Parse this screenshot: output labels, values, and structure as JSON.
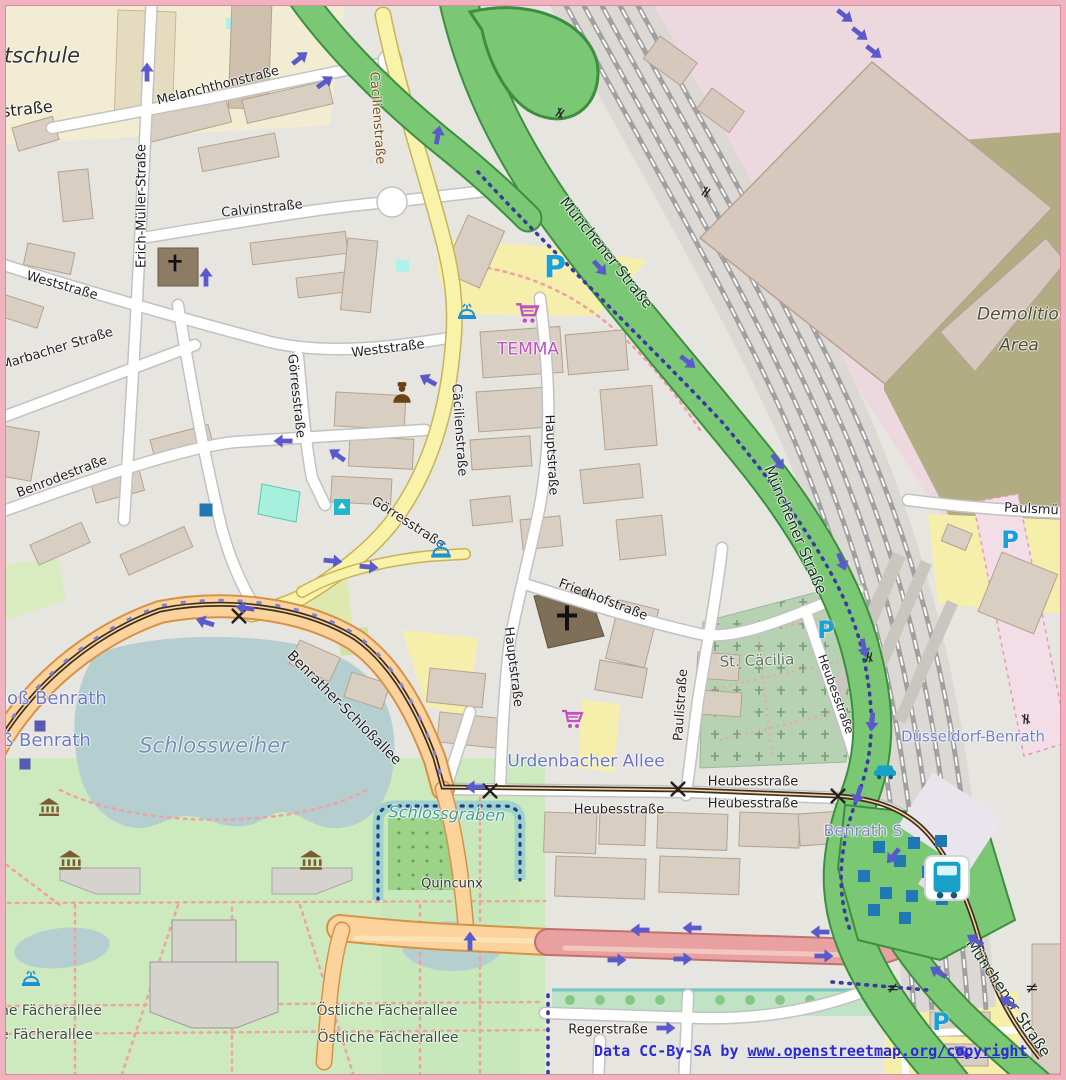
{
  "map": {
    "attribution": {
      "prefix": "Data CC-By-SA by ",
      "link": "www.openstreetmap.org/copyright"
    },
    "colors": {
      "frame_pink": "#f1b2c0",
      "residential_bg": "#e7e5e0",
      "building": "#d8cec2",
      "road_yellow": "#f8f3a8",
      "road_orange": "#fcd39c",
      "road_green_trunk": "#7ac873",
      "road_red": "#e9a0a0",
      "water": "#b5cfd1",
      "park_green": "#cdeabf",
      "cemetery_green": "#b7d2b2",
      "industrial_pink": "#edd8e0",
      "brownfield_khaki": "#b2ac83",
      "label_blue_place": "#6b79c8",
      "label_water_blue": "#7292b2",
      "temma_magenta": "#c050c0",
      "parking_blue": "#18a0d8",
      "oneway_arrow": "#5a5acd",
      "attribution_blue": "#2b2bd6"
    },
    "labels": [
      {
        "t": "tschule",
        "x": 4,
        "y": 56,
        "s": 21,
        "c": "#333333",
        "a": "l",
        "i": true
      },
      {
        "t": "straße",
        "x": 2,
        "y": 112,
        "s": 16,
        "c": "#222222",
        "a": "l",
        "r": -6
      },
      {
        "t": "Melanchthonstraße",
        "x": 218,
        "y": 86,
        "r": -14,
        "s": 13
      },
      {
        "t": "Erich-Müller-Straße",
        "x": 142,
        "y": 206,
        "r": -90,
        "s": 13
      },
      {
        "t": "Calvinstraße",
        "x": 262,
        "y": 209,
        "r": -6,
        "s": 13
      },
      {
        "t": "Weststraße",
        "x": 62,
        "y": 286,
        "r": 16,
        "s": 13
      },
      {
        "t": "Weststraße",
        "x": 388,
        "y": 349,
        "r": -7,
        "s": 13
      },
      {
        "t": "Marbacher Straße",
        "x": 57,
        "y": 349,
        "r": -17,
        "s": 13
      },
      {
        "t": "Benrodestraße",
        "x": 62,
        "y": 477,
        "r": -21,
        "s": 13
      },
      {
        "t": "Görresstraße",
        "x": 296,
        "y": 396,
        "r": 84,
        "s": 13
      },
      {
        "t": "Görresstraße",
        "x": 408,
        "y": 523,
        "r": 33,
        "s": 13
      },
      {
        "t": "Cäcilienstraße",
        "x": 377,
        "y": 118,
        "r": 86,
        "s": 13,
        "c": "#7a4e18"
      },
      {
        "t": "Cäcilienstraße",
        "x": 459,
        "y": 430,
        "r": 86,
        "s": 13
      },
      {
        "t": "Hauptstraße",
        "x": 551,
        "y": 455,
        "r": 87,
        "s": 13
      },
      {
        "t": "Hauptstraße",
        "x": 513,
        "y": 667,
        "r": 83,
        "s": 13
      },
      {
        "t": "Münchener Straße",
        "x": 606,
        "y": 253,
        "r": 51,
        "s": 15,
        "c": "#17301c"
      },
      {
        "t": "Münchener Straße",
        "x": 795,
        "y": 530,
        "r": 67,
        "s": 15,
        "c": "#17301c"
      },
      {
        "t": "Münchener Straße",
        "x": 1008,
        "y": 998,
        "r": 56,
        "s": 15,
        "c": "#17301c"
      },
      {
        "t": "Demolition",
        "x": 977,
        "y": 315,
        "s": 17,
        "c": "#4c4c38",
        "i": true,
        "a": "l"
      },
      {
        "t": "Area",
        "x": 1019,
        "y": 346,
        "s": 17,
        "c": "#4c4c38",
        "i": true
      },
      {
        "t": "TEMMA",
        "x": 528,
        "y": 350,
        "s": 17,
        "c": "#c050c0"
      },
      {
        "t": "Friedhofstraße",
        "x": 603,
        "y": 600,
        "r": 21,
        "s": 13
      },
      {
        "t": "St. Cäcilia",
        "x": 757,
        "y": 661,
        "r": -2,
        "s": 15,
        "c": "#5d6e5d"
      },
      {
        "t": "Paulistraße",
        "x": 681,
        "y": 705,
        "r": -86,
        "s": 13
      },
      {
        "t": "Heubesstraße",
        "x": 836,
        "y": 694,
        "r": 70,
        "s": 12
      },
      {
        "t": "Paulsmü",
        "x": 1004,
        "y": 508,
        "s": 13,
        "a": "l",
        "r": 3
      },
      {
        "t": "Düsseldorf-Benrath",
        "x": 973,
        "y": 737,
        "s": 15,
        "c": "#7080c8"
      },
      {
        "t": "loß Benrath",
        "x": 2,
        "y": 699,
        "s": 18,
        "c": "#6b79c8",
        "a": "l"
      },
      {
        "t": "ß Benrath",
        "x": 2,
        "y": 741,
        "s": 18,
        "c": "#6b79c8",
        "a": "l"
      },
      {
        "t": "Schlossweiher",
        "x": 214,
        "y": 746,
        "s": 21,
        "c": "#7292b2",
        "i": true
      },
      {
        "t": "Benrather-Schloßallee",
        "x": 344,
        "y": 708,
        "r": 45,
        "s": 14
      },
      {
        "t": "Schlossgraben",
        "x": 447,
        "y": 814,
        "s": 16,
        "c": "#3e9d9d",
        "i": true,
        "r": 2
      },
      {
        "t": "Urdenbacher Allee",
        "x": 586,
        "y": 762,
        "s": 17,
        "c": "#6b74c8"
      },
      {
        "t": "Heubesstraße",
        "x": 753,
        "y": 782,
        "s": 13
      },
      {
        "t": "Heubesstraße",
        "x": 619,
        "y": 810,
        "s": 13
      },
      {
        "t": "Heubesstraße",
        "x": 753,
        "y": 804,
        "s": 13
      },
      {
        "t": "Benrath S",
        "x": 863,
        "y": 831,
        "s": 16,
        "c": "#8a7fd0"
      },
      {
        "t": "Quincunx",
        "x": 452,
        "y": 884,
        "s": 13,
        "c": "#333333"
      },
      {
        "t": "he Fächerallee",
        "x": 0,
        "y": 1011,
        "s": 14,
        "c": "#3d4d3d",
        "a": "l"
      },
      {
        "t": "e Fächerallee",
        "x": 0,
        "y": 1035,
        "s": 14,
        "c": "#3d4d3d",
        "a": "l"
      },
      {
        "t": "Östliche Fächerallee",
        "x": 387,
        "y": 1011,
        "s": 14,
        "c": "#3d4d3d"
      },
      {
        "t": "Östliche Fächerallee",
        "x": 388,
        "y": 1038,
        "s": 14,
        "c": "#3d4d3d"
      },
      {
        "t": "Regerstraße",
        "x": 608,
        "y": 1030,
        "s": 13
      }
    ],
    "icons": [
      {
        "n": "parking-icon",
        "k": "parking",
        "x": 555,
        "y": 268,
        "s": 30,
        "c": "#18a0d8"
      },
      {
        "n": "parking-icon",
        "k": "parking",
        "x": 826,
        "y": 630,
        "s": 24,
        "c": "#18a0d8"
      },
      {
        "n": "parking-icon",
        "k": "parking",
        "x": 1010,
        "y": 540,
        "s": 24,
        "c": "#18a0d8"
      },
      {
        "n": "parking-icon",
        "k": "parking",
        "x": 941,
        "y": 1022,
        "s": 24,
        "c": "#18a0d8"
      },
      {
        "n": "supermarket-cart-icon",
        "k": "cart",
        "x": 527,
        "y": 313,
        "s": 26,
        "c": "#c050c0"
      },
      {
        "n": "supermarket-cart-icon",
        "k": "cart",
        "x": 572,
        "y": 719,
        "s": 24,
        "c": "#c050c0"
      },
      {
        "n": "church-cross-icon",
        "k": "church",
        "x": 175,
        "y": 263,
        "s": 20,
        "c": "#111111"
      },
      {
        "n": "church-cross-icon",
        "k": "church",
        "x": 567,
        "y": 618,
        "s": 30,
        "c": "#111111"
      },
      {
        "n": "fountain-icon",
        "k": "fountain",
        "x": 467,
        "y": 311,
        "s": 24,
        "c": "#2090d8"
      },
      {
        "n": "fountain-icon",
        "k": "fountain",
        "x": 441,
        "y": 549,
        "s": 26,
        "c": "#2090d8"
      },
      {
        "n": "fountain-icon",
        "k": "fountain",
        "x": 31,
        "y": 978,
        "s": 24,
        "c": "#2090d8"
      },
      {
        "n": "museum-icon",
        "k": "museum",
        "x": 49,
        "y": 807,
        "s": 24,
        "c": "#7a5c2e"
      },
      {
        "n": "museum-icon",
        "k": "museum",
        "x": 70,
        "y": 860,
        "s": 26,
        "c": "#7a5c2e"
      },
      {
        "n": "museum-icon",
        "k": "museum",
        "x": 311,
        "y": 860,
        "s": 26,
        "c": "#7a5c2e"
      },
      {
        "n": "post-office-icon",
        "k": "post",
        "x": 402,
        "y": 393,
        "s": 26,
        "c": "#6a4418"
      },
      {
        "n": "recycling-icon",
        "k": "recycle",
        "x": 342,
        "y": 507,
        "s": 16,
        "c": "#20b8c8"
      },
      {
        "n": "poi-blue-square-icon",
        "k": "sq",
        "x": 206,
        "y": 510,
        "s": 13,
        "c": "#1f77b4"
      },
      {
        "n": "tram-stop-icon",
        "k": "sq",
        "x": 40,
        "y": 726,
        "s": 11,
        "c": "#5a5ab0"
      },
      {
        "n": "tram-stop-icon",
        "k": "sq",
        "x": 25,
        "y": 764,
        "s": 11,
        "c": "#5a5ab0"
      },
      {
        "n": "bus-stop-icon",
        "k": "sq",
        "x": 879,
        "y": 847,
        "s": 12,
        "c": "#1f77b4"
      },
      {
        "n": "bus-stop-icon",
        "k": "sq",
        "x": 914,
        "y": 843,
        "s": 12,
        "c": "#1f77b4"
      },
      {
        "n": "bus-stop-icon",
        "k": "sq",
        "x": 941,
        "y": 841,
        "s": 12,
        "c": "#1f77b4"
      },
      {
        "n": "bus-stop-icon",
        "k": "sq",
        "x": 900,
        "y": 861,
        "s": 12,
        "c": "#1f77b4"
      },
      {
        "n": "bus-stop-icon",
        "k": "sq",
        "x": 864,
        "y": 876,
        "s": 12,
        "c": "#1f77b4"
      },
      {
        "n": "bus-stop-icon",
        "k": "sq",
        "x": 928,
        "y": 872,
        "s": 12,
        "c": "#1f77b4"
      },
      {
        "n": "bus-stop-icon",
        "k": "sq",
        "x": 952,
        "y": 868,
        "s": 12,
        "c": "#1f77b4"
      },
      {
        "n": "bus-stop-icon",
        "k": "sq",
        "x": 886,
        "y": 893,
        "s": 12,
        "c": "#1f77b4"
      },
      {
        "n": "bus-stop-icon",
        "k": "sq",
        "x": 912,
        "y": 896,
        "s": 12,
        "c": "#1f77b4"
      },
      {
        "n": "bus-stop-icon",
        "k": "sq",
        "x": 942,
        "y": 899,
        "s": 12,
        "c": "#1f77b4"
      },
      {
        "n": "bus-stop-icon",
        "k": "sq",
        "x": 874,
        "y": 910,
        "s": 12,
        "c": "#1f77b4"
      },
      {
        "n": "bus-stop-icon",
        "k": "sq",
        "x": 905,
        "y": 918,
        "s": 12,
        "c": "#1f77b4"
      },
      {
        "n": "bus-station-icon",
        "k": "bus",
        "x": 947,
        "y": 878,
        "s": 46,
        "c": "#18a0c8"
      },
      {
        "n": "taxi-icon",
        "k": "taxi",
        "x": 885,
        "y": 769,
        "s": 28,
        "c": "#18a0c8"
      },
      {
        "n": "level-crossing-icon",
        "k": "xmark",
        "x": 239,
        "y": 616,
        "s": 17,
        "c": "#222222"
      },
      {
        "n": "level-crossing-icon",
        "k": "xmark",
        "x": 490,
        "y": 791,
        "s": 17,
        "c": "#222222"
      },
      {
        "n": "level-crossing-icon",
        "k": "xmark",
        "x": 678,
        "y": 789,
        "s": 17,
        "c": "#222222"
      },
      {
        "n": "level-crossing-icon",
        "k": "xmark",
        "x": 838,
        "y": 796,
        "s": 17,
        "c": "#222222"
      },
      {
        "n": "rail-gate-icon",
        "k": "gate",
        "x": 560,
        "y": 113,
        "r": -55,
        "s": 16
      },
      {
        "n": "rail-gate-icon",
        "k": "gate",
        "x": 706,
        "y": 192,
        "r": -55,
        "s": 16
      },
      {
        "n": "rail-gate-icon",
        "k": "gate",
        "x": 869,
        "y": 657,
        "r": -78,
        "s": 16
      },
      {
        "n": "rail-gate-icon",
        "k": "gate",
        "x": 1026,
        "y": 719,
        "r": -85,
        "s": 16
      },
      {
        "n": "rail-gate-icon",
        "k": "gate",
        "x": 893,
        "y": 988,
        "r": 0,
        "s": 16
      },
      {
        "n": "rail-gate-icon",
        "k": "gate",
        "x": 1032,
        "y": 988,
        "r": 0,
        "s": 16
      }
    ],
    "arrows": [
      {
        "x": 147,
        "y": 72,
        "r": -90
      },
      {
        "x": 206,
        "y": 277,
        "r": -90
      },
      {
        "x": 438,
        "y": 135,
        "r": -80
      },
      {
        "x": 300,
        "y": 58,
        "r": -38
      },
      {
        "x": 325,
        "y": 82,
        "r": -35
      },
      {
        "x": 845,
        "y": 16,
        "r": 38
      },
      {
        "x": 860,
        "y": 34,
        "r": 38
      },
      {
        "x": 874,
        "y": 52,
        "r": 38
      },
      {
        "x": 600,
        "y": 268,
        "r": 48
      },
      {
        "x": 688,
        "y": 362,
        "r": 38
      },
      {
        "x": 778,
        "y": 462,
        "r": 52
      },
      {
        "x": 842,
        "y": 562,
        "r": 68
      },
      {
        "x": 864,
        "y": 648,
        "r": 80
      },
      {
        "x": 872,
        "y": 722,
        "r": 95
      },
      {
        "x": 858,
        "y": 795,
        "r": 108
      },
      {
        "x": 975,
        "y": 940,
        "r": 212
      },
      {
        "x": 938,
        "y": 972,
        "r": 212
      },
      {
        "x": 1008,
        "y": 1002,
        "r": 212
      },
      {
        "x": 962,
        "y": 1052,
        "r": 215
      },
      {
        "x": 283,
        "y": 441,
        "r": 180
      },
      {
        "x": 337,
        "y": 455,
        "r": -145
      },
      {
        "x": 333,
        "y": 561,
        "r": 5
      },
      {
        "x": 369,
        "y": 567,
        "r": 5
      },
      {
        "x": 428,
        "y": 380,
        "r": -150
      },
      {
        "x": 640,
        "y": 930,
        "r": 180
      },
      {
        "x": 692,
        "y": 928,
        "r": 180
      },
      {
        "x": 820,
        "y": 932,
        "r": 180
      },
      {
        "x": 617,
        "y": 960,
        "r": 0
      },
      {
        "x": 683,
        "y": 959,
        "r": 0
      },
      {
        "x": 824,
        "y": 956,
        "r": 0
      },
      {
        "x": 470,
        "y": 941,
        "r": -90
      },
      {
        "x": 475,
        "y": 787,
        "r": 180
      },
      {
        "x": 666,
        "y": 1028,
        "r": 0
      },
      {
        "x": 205,
        "y": 622,
        "r": 198
      },
      {
        "x": 245,
        "y": 608,
        "r": 188
      },
      {
        "x": 893,
        "y": 856,
        "r": 130
      }
    ]
  }
}
